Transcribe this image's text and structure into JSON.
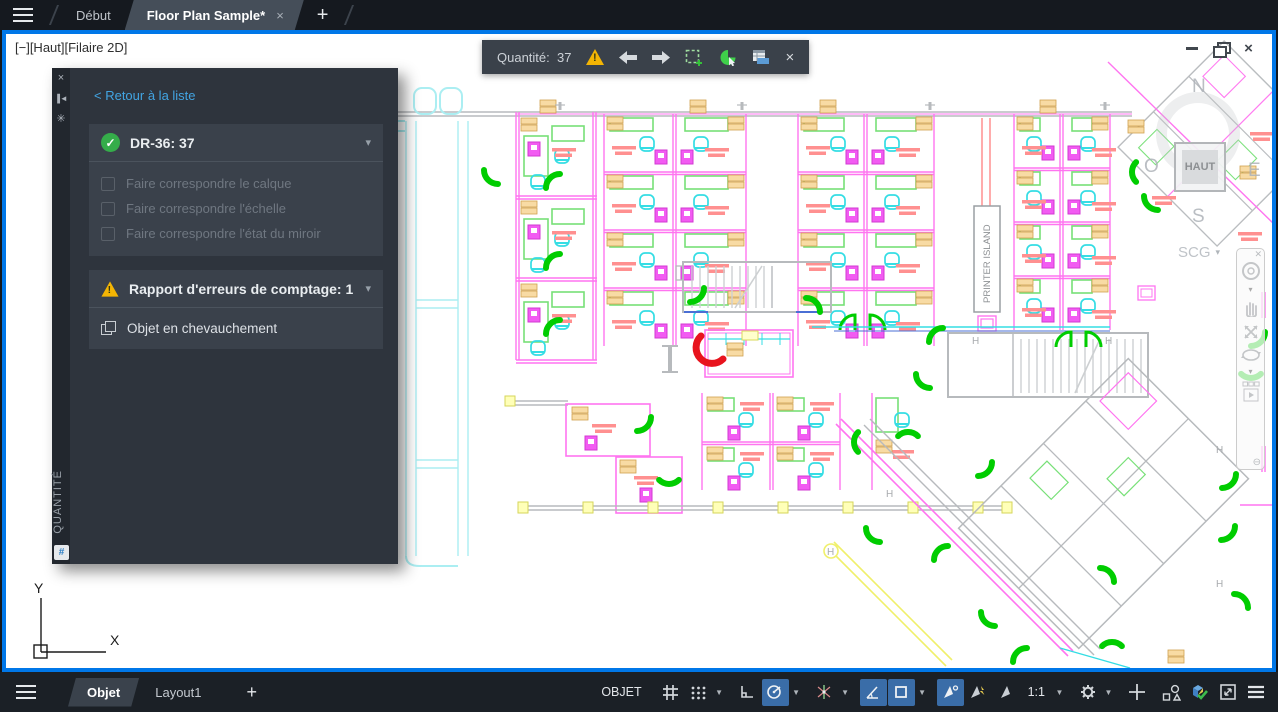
{
  "colors": {
    "window_border": "#0077e8",
    "accent_link": "#42a4e2",
    "warning_yellow": "#f4b504",
    "success_green": "#35ad4a",
    "door_green": "#00cd00",
    "error_red": "#e8131d",
    "status_active_blue": "#3a6da8",
    "panel_bg": "#2e343d",
    "card_bg": "#3a414b"
  },
  "icons": {
    "menu": "≡",
    "close": "×",
    "plus": "+",
    "chevron_down": "▾",
    "gear": "✳",
    "back_arrow": "◄"
  },
  "tab_bar": {
    "tabs": [
      {
        "label": "Début",
        "active": false
      },
      {
        "label": "Floor Plan Sample*",
        "active": true
      }
    ]
  },
  "viewport_controls": {
    "label": "[−][Haut][Filaire 2D]"
  },
  "count_toolbar": {
    "label": "Quantité:",
    "value": "37"
  },
  "palette": {
    "vertical_title": "QUANTITÉ",
    "back_link": "< Retour à la liste",
    "count_item": {
      "label": "DR-36: 37",
      "status": "ok"
    },
    "options": [
      {
        "label": "Faire correspondre le calque",
        "checked": false
      },
      {
        "label": "Faire correspondre l'échelle",
        "checked": false
      },
      {
        "label": "Faire correspondre l'état du miroir",
        "checked": false
      }
    ],
    "error_section": {
      "label": "Rapport d'erreurs de comptage: 1"
    },
    "error_item": {
      "label": "Objet en chevauchement"
    }
  },
  "viewcube": {
    "north": "N",
    "west": "O",
    "east": "E",
    "south": "S",
    "face": "HAUT",
    "coord_label": "SCG"
  },
  "canvas_text": {
    "printer_island": "PRINTER ISLAND",
    "axis_x": "X",
    "axis_y": "Y"
  },
  "status_bar": {
    "model_tab": "Objet",
    "layout_tab": "Layout1",
    "space_button": "OBJET",
    "scale_value": "1:1"
  },
  "drawing_meta": {
    "counted_block": "DR-36",
    "count": 37,
    "error_count": 1
  }
}
